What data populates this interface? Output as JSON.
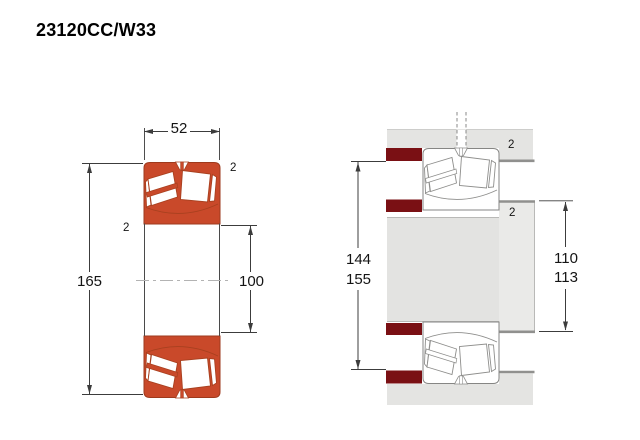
{
  "title": "23120CC/W33",
  "colors": {
    "bearing_orange": "#c9492a",
    "locating_ring_red": "#7a1014",
    "housing_gray": "#e4e4e2",
    "shaft_gray": "#e3e3e1",
    "shoulder_gray": "#eaeae8",
    "edge_gray": "#90908e",
    "outline_gray": "#8a8a88",
    "dim_line": "#3c3c3c",
    "dim_text": "#141414",
    "centerline_gray": "#b3b3b3"
  },
  "left_view": {
    "width_dim": "52",
    "outside_diameter_dim": "165",
    "bore_diameter_dim": "100",
    "od_corner_dim": "2",
    "bore_corner_dim": "2"
  },
  "right_view": {
    "housing_abutment_min": "144",
    "housing_abutment_max": "155",
    "shaft_abutment_min": "110",
    "shaft_abutment_max": "113",
    "housing_corner_dim": "2",
    "shaft_corner_dim": "2"
  }
}
